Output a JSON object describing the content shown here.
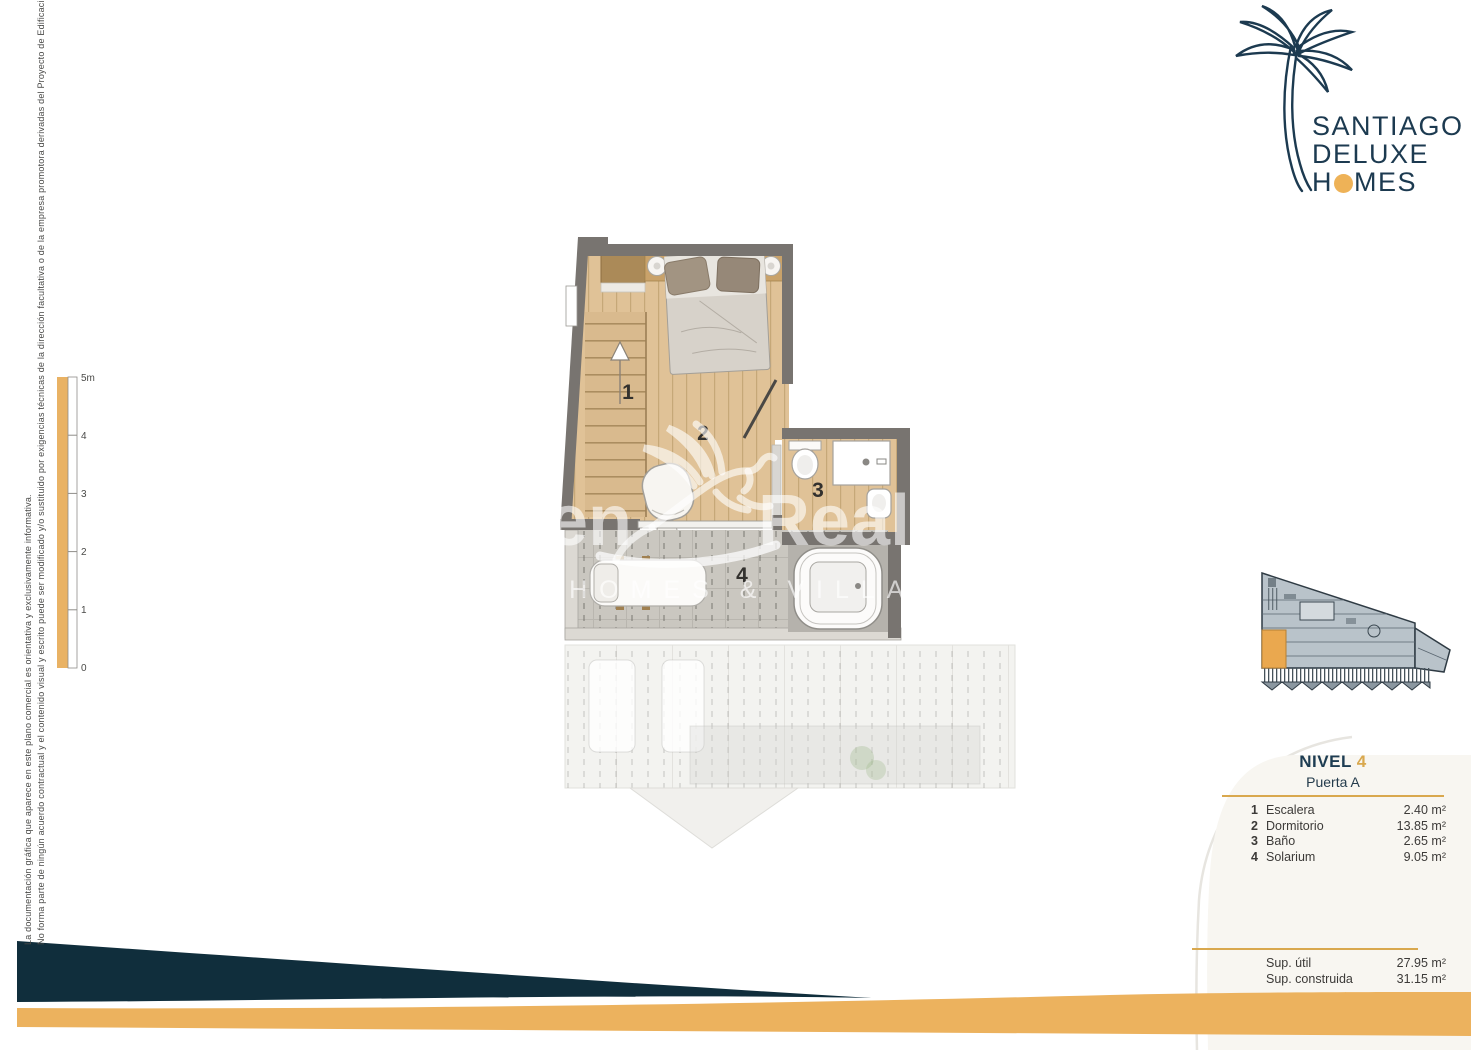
{
  "disclaimer": {
    "line_outer": "La documentación gráfica que aparece en este plano comercial es orientativa y exclusivamente informativa.",
    "line_inner": "No forma parte de ningún acuerdo contractual y el contenido visual y escrito puede ser modificado y/o sustituido por exigencias técnicas de la dirección facultativa o de la empresa promotora derivadas del Proyecto de Edificación y su ejecución."
  },
  "logo": {
    "line1": "SANTIAGO",
    "line2": "DELUXE",
    "line3_pre": "H",
    "line3_post": "MES"
  },
  "scale_bar": {
    "labels": [
      "5m",
      "4",
      "3",
      "2",
      "1",
      "0"
    ]
  },
  "floor_plan": {
    "room_numbers": [
      "1",
      "2",
      "3",
      "4"
    ],
    "watermark": {
      "word1": "Asten",
      "word2": "Realty",
      "tagline": "NEW HOMES & VILLAS"
    }
  },
  "info_panel": {
    "level_label": "NIVEL",
    "level_number": "4",
    "door": "Puerta A",
    "legend": [
      {
        "num": "1",
        "name": "Escalera",
        "area": "2.40 m²"
      },
      {
        "num": "2",
        "name": "Dormitorio",
        "area": "13.85 m²"
      },
      {
        "num": "3",
        "name": "Baño",
        "area": "2.65 m²"
      },
      {
        "num": "4",
        "name": "Solarium",
        "area": "9.05 m²"
      }
    ],
    "totals": [
      {
        "name": "Sup. útil",
        "area": "27.95 m²"
      },
      {
        "name": "Sup. construida",
        "area": "31.15 m²"
      }
    ]
  },
  "colors": {
    "navy": "#1c3a50",
    "navy_swoosh": "#102e3c",
    "gold": "#e9b45f",
    "gold_dark": "#d9a84e",
    "wall_gray": "#787470",
    "wood": "#e0c297",
    "cream_card": "#f8f6f1"
  }
}
